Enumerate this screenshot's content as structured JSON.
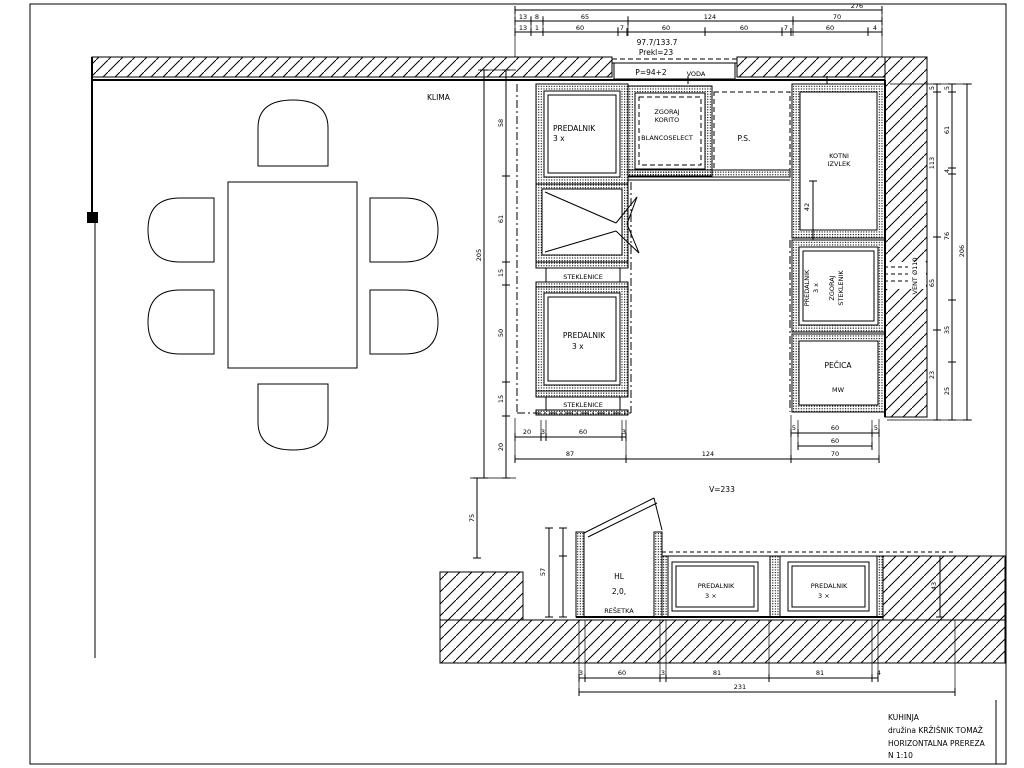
{
  "title_block": {
    "line1": "KUHINJA",
    "line2": "družina KRŽIŠNIK TOMAŽ",
    "line3": "HORIZONTALNA PREREZA",
    "line4": "N 1:10"
  },
  "notes": {
    "klima": "KLIMA",
    "dim_note": "97.7/133.7",
    "prekl": "Prekl=23",
    "p": "P=94+2",
    "voda": "VODA",
    "v": "V=233",
    "vent": "VENT Ø110"
  },
  "plan": {
    "predalnik_top": {
      "l1": "PREDALNIK",
      "l2": "3 x"
    },
    "steklenice_upper": "STEKLENICE",
    "predalnik_mid": {
      "l1": "PREDALNIK",
      "l2": "3 x"
    },
    "steklenice_lower": "STEKLENICE",
    "sink": {
      "l1": "ZGORAJ",
      "l2": "KORITO",
      "l3": "BLANCOSELECT"
    },
    "ps": "P.S.",
    "kotni": {
      "l1": "KOTNI",
      "l2": "IZVLEK"
    },
    "right_mid": {
      "l1": "PREDALNIK",
      "l2": "3 x",
      "l3": "ZGORAJ",
      "l4": "STEKLENIK"
    },
    "pecica": {
      "l1": "PEČICA",
      "l2": "MW"
    }
  },
  "section": {
    "hl": {
      "l1": "HL",
      "l2": "2,0,",
      "l3": "REŠETKA"
    },
    "pred1": {
      "l1": "PREDALNIK",
      "l2": "3 ×"
    },
    "pred2": {
      "l1": "PREDALNIK",
      "l2": "3 ×"
    }
  },
  "dims": {
    "top_overall": "276",
    "top_row2": [
      "13",
      "8",
      "65",
      "124",
      "70"
    ],
    "top_row3": [
      "13",
      "1",
      "60",
      "7",
      "60",
      "60",
      "7",
      "60",
      "4"
    ],
    "left_overall": "205",
    "left_inner": [
      "58",
      "61",
      "15",
      "50",
      "15",
      "20"
    ],
    "left_lower": "75",
    "right_overall": "206",
    "right_mid": [
      "5",
      "61",
      "4",
      "76",
      "35",
      "25"
    ],
    "right_inner": [
      "5",
      "113",
      "65",
      "23"
    ],
    "kotni": "42",
    "plan_bottom_main": [
      "87",
      "124",
      "70"
    ],
    "plan_bottom_left": [
      "20",
      "3",
      "60",
      "3"
    ],
    "plan_bottom_right1": [
      "5",
      "60",
      "5"
    ],
    "plan_bottom_right2": "60",
    "section_bottom": [
      "3",
      "60",
      "3",
      "81",
      "81",
      "4"
    ],
    "section_overall": "231",
    "section_left": "57",
    "section_right": "43"
  }
}
